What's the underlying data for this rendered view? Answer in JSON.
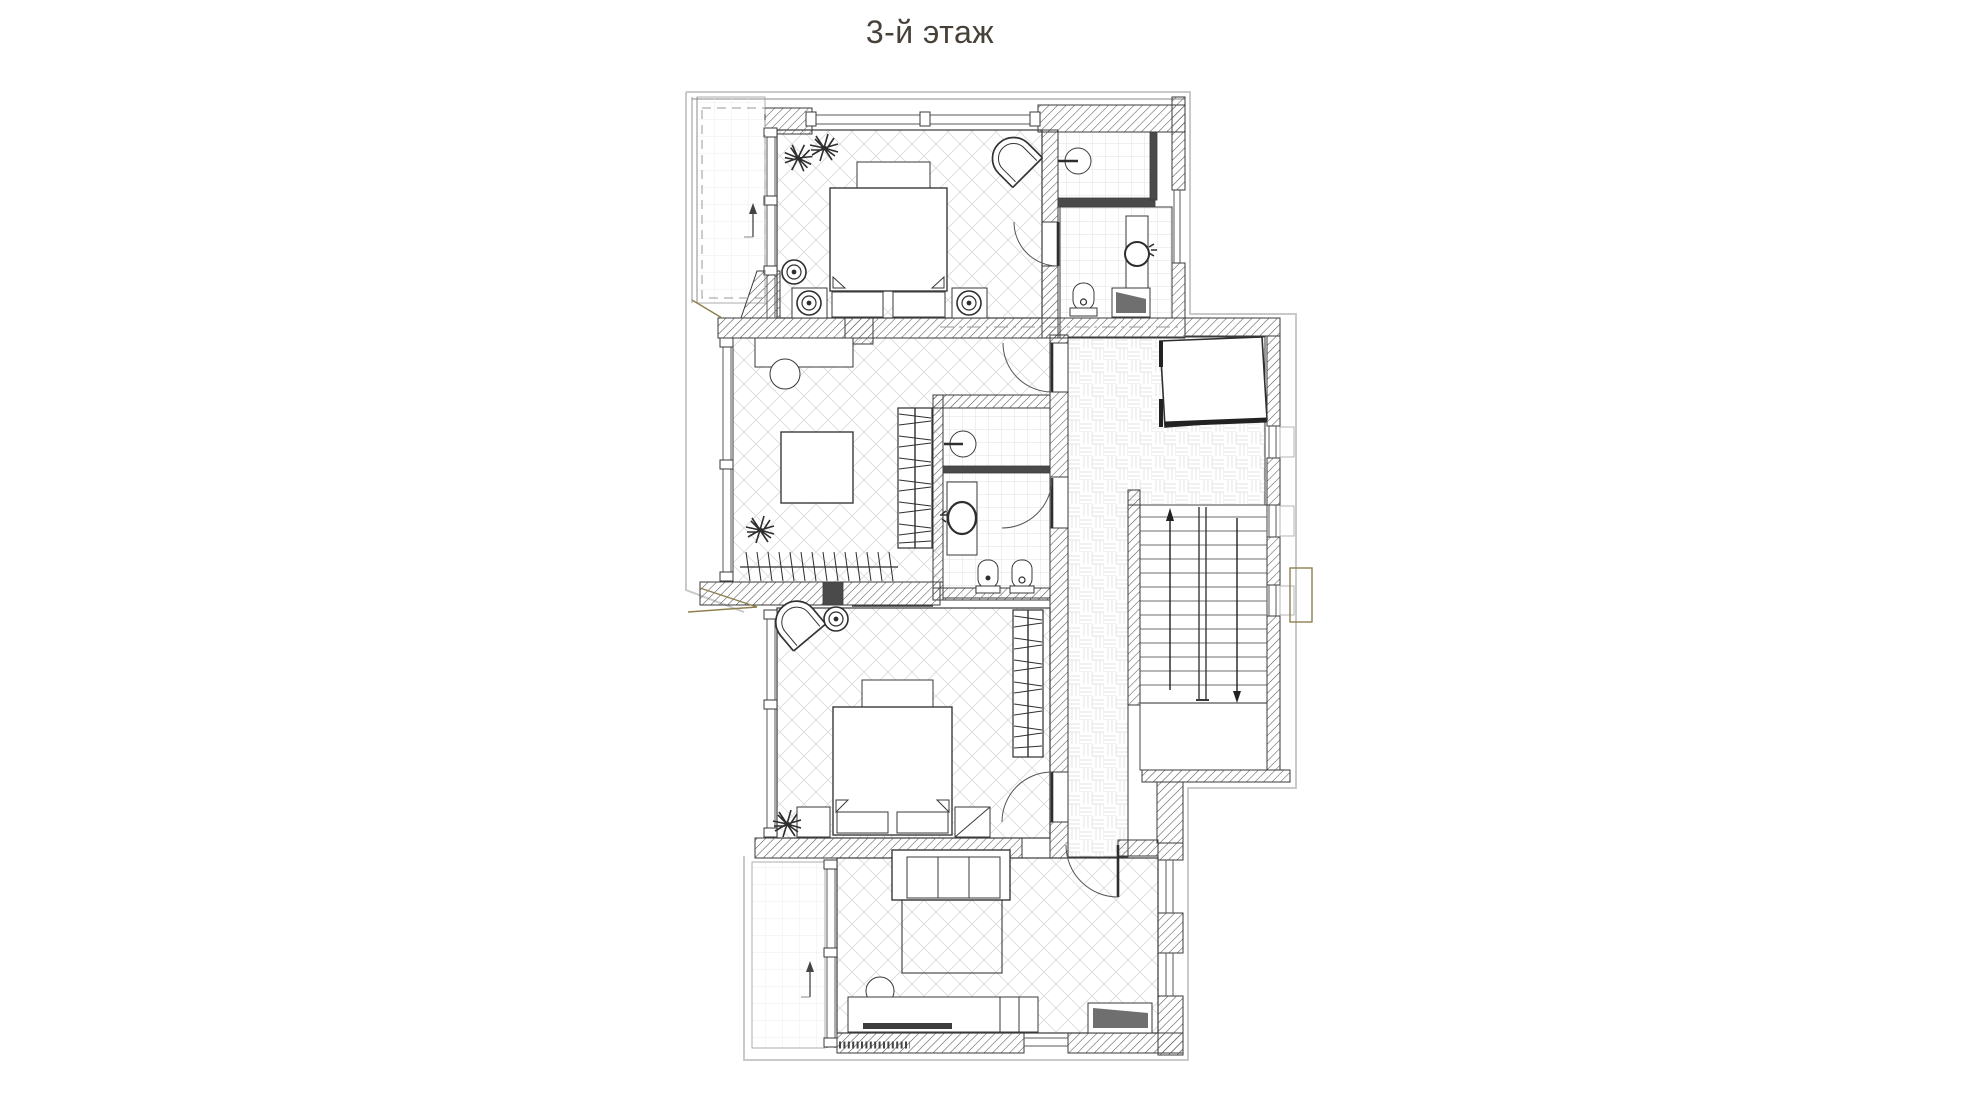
{
  "title": {
    "text": "3-й этаж"
  },
  "palette": {
    "title_color": "#47413a",
    "ink": "#3a3a3a",
    "wall_hatch": "#555555",
    "floor_grid": "#dcdcdc",
    "tile_grid": "#e2e2e2",
    "parquet_grid": "#e3e3e3",
    "accent_tan": "#8f7f4f",
    "exterior_outline": "#c9c9c9"
  }
}
